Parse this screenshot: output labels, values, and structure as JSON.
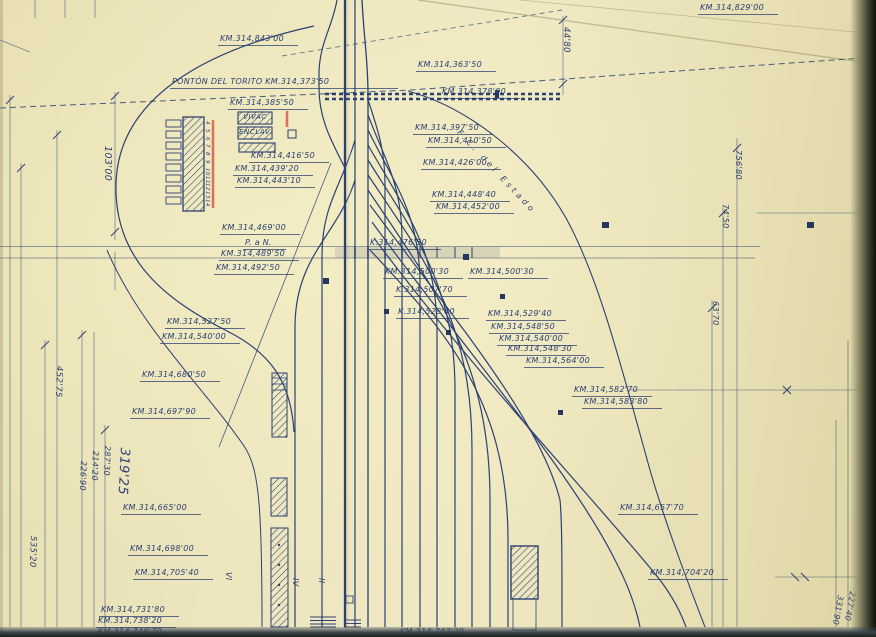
{
  "drawing": {
    "paper_color": "#ece5bd",
    "ink_color": "#2a4173",
    "red_accent": "#dd5a4a",
    "structure_labels": {
      "vivac": "VIVAC",
      "enclav": "ENCLAV.",
      "estado_line": "F.C. del Estado"
    },
    "km_labels": [
      {
        "text": "KM.314,829'00",
        "x": 698,
        "y": 4
      },
      {
        "text": "KM.314,843'00",
        "x": 218,
        "y": 35
      },
      {
        "text": "KM.314,363'50",
        "x": 416,
        "y": 61
      },
      {
        "text": "PONTÓN DEL TORITO  KM.314,373'50",
        "x": 170,
        "y": 78,
        "w": 212
      },
      {
        "text": "KM.314,378'00",
        "x": 440,
        "y": 88
      },
      {
        "text": "KM.314,385'50",
        "x": 228,
        "y": 99
      },
      {
        "text": "KM.314,397'50",
        "x": 413,
        "y": 124
      },
      {
        "text": "KM.314,410'50",
        "x": 426,
        "y": 137
      },
      {
        "text": "KM.314,416'50",
        "x": 249,
        "y": 152
      },
      {
        "text": "KM.314,426'00",
        "x": 421,
        "y": 159
      },
      {
        "text": "KM.314,439'20",
        "x": 233,
        "y": 165
      },
      {
        "text": "KM.314,443'10",
        "x": 235,
        "y": 177
      },
      {
        "text": "KM.314,448'40",
        "x": 430,
        "y": 191
      },
      {
        "text": "KM.314,452'00",
        "x": 434,
        "y": 203
      },
      {
        "text": "KM.314,469'00",
        "x": 220,
        "y": 224
      },
      {
        "text": "P. a N.",
        "x": 243,
        "y": 239
      },
      {
        "text": "K.314,476'50",
        "x": 368,
        "y": 239
      },
      {
        "text": "KM.314,489'50",
        "x": 219,
        "y": 250
      },
      {
        "text": "KM.314,492'50",
        "x": 214,
        "y": 264
      },
      {
        "text": "KM.314,500'30",
        "x": 383,
        "y": 268
      },
      {
        "text": "KM.314,500'30",
        "x": 468,
        "y": 268
      },
      {
        "text": "K.314,507'70",
        "x": 394,
        "y": 286
      },
      {
        "text": "K.314,528'40",
        "x": 396,
        "y": 308
      },
      {
        "text": "KM.314,529'40",
        "x": 486,
        "y": 310
      },
      {
        "text": "KM.314,527'50",
        "x": 165,
        "y": 318
      },
      {
        "text": "KM.314,548'50",
        "x": 489,
        "y": 323
      },
      {
        "text": "KM.314,540'00",
        "x": 160,
        "y": 333
      },
      {
        "text": "KM.314,540'00",
        "x": 497,
        "y": 335
      },
      {
        "text": "KM.314,548'30",
        "x": 506,
        "y": 345
      },
      {
        "text": "KM.314,564'00",
        "x": 524,
        "y": 357
      },
      {
        "text": "KM.314,680'50",
        "x": 140,
        "y": 371
      },
      {
        "text": "KM.314,582'70",
        "x": 572,
        "y": 386
      },
      {
        "text": "KM.314,583'80",
        "x": 582,
        "y": 398
      },
      {
        "text": "KM.314,697'90",
        "x": 130,
        "y": 408
      },
      {
        "text": "KM.314,665'00",
        "x": 121,
        "y": 504
      },
      {
        "text": "KM.314,657'70",
        "x": 618,
        "y": 504
      },
      {
        "text": "KM.314,698'00",
        "x": 128,
        "y": 545
      },
      {
        "text": "KM.314,705'40",
        "x": 133,
        "y": 569
      },
      {
        "text": "KM.314,704'20",
        "x": 648,
        "y": 569
      },
      {
        "text": "KM.314,731'80",
        "x": 99,
        "y": 606
      },
      {
        "text": "KM.314,738'20",
        "x": 96,
        "y": 617
      },
      {
        "text": "KM.314,748'70",
        "x": 96,
        "y": 628
      },
      {
        "text": "KM.314,743'20",
        "x": 398,
        "y": 628
      }
    ],
    "dim_labels": [
      {
        "text": "103'00",
        "x": 112,
        "y": 146,
        "rot": 90,
        "size": 9.5
      },
      {
        "text": "44'80",
        "x": 570,
        "y": 27,
        "rot": 90,
        "size": 8.5
      },
      {
        "text": "756'80",
        "x": 742,
        "y": 150,
        "rot": 90,
        "size": 8
      },
      {
        "text": "74'50",
        "x": 729,
        "y": 204,
        "rot": 90,
        "size": 8
      },
      {
        "text": "63'70",
        "x": 719,
        "y": 301,
        "rot": 90,
        "size": 8
      },
      {
        "text": "452'75",
        "x": 63,
        "y": 366,
        "rot": 92,
        "size": 8.5
      },
      {
        "text": "535'20",
        "x": 37,
        "y": 536,
        "rot": 92,
        "size": 8.5
      },
      {
        "text": "226'90",
        "x": 87,
        "y": 461,
        "rot": 92,
        "size": 8
      },
      {
        "text": "214'20",
        "x": 99,
        "y": 451,
        "rot": 92,
        "size": 8
      },
      {
        "text": "287'30",
        "x": 111,
        "y": 446,
        "rot": 92,
        "size": 8
      },
      {
        "text": "319'25",
        "x": 131,
        "y": 448,
        "rot": 93,
        "size": 13
      },
      {
        "text": "347'",
        "x": 868,
        "y": 592,
        "rot": 100,
        "size": 8
      },
      {
        "text": "227'40",
        "x": 856,
        "y": 592,
        "rot": 100,
        "size": 8
      },
      {
        "text": "331'90",
        "x": 844,
        "y": 596,
        "rot": 100,
        "size": 8
      }
    ],
    "track_numbers": [
      {
        "text": "VI",
        "x": 232,
        "y": 572,
        "rot": 90
      },
      {
        "text": "IV",
        "x": 299,
        "y": 578,
        "rot": 90
      },
      {
        "text": "II",
        "x": 325,
        "y": 578,
        "rot": 90
      }
    ],
    "building_door_numbers": [
      "4",
      "5",
      "6",
      "7",
      "8",
      "9",
      "10",
      "11",
      "12",
      "13",
      "14"
    ]
  }
}
